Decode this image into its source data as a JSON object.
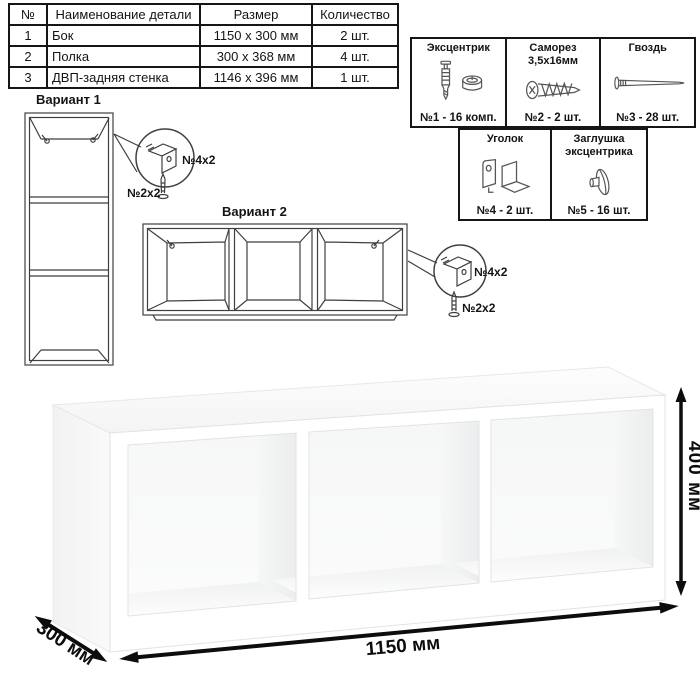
{
  "parts_table": {
    "headers": [
      "№",
      "Наименование детали",
      "Размер",
      "Количество"
    ],
    "rows": [
      {
        "num": "1",
        "name": "Бок",
        "size": "1150 х 300 мм",
        "qty": "2 шт."
      },
      {
        "num": "2",
        "name": "Полка",
        "size": "300 х 368 мм",
        "qty": "4 шт."
      },
      {
        "num": "3",
        "name": "ДВП-задняя стенка",
        "size": "1146 х 396 мм",
        "qty": "1 шт."
      }
    ]
  },
  "hardware": {
    "items": [
      {
        "title": "Эксцентрик",
        "title2": "",
        "icon": "cam-bolt-and-cam-icon",
        "count": "№1 - 16 комп."
      },
      {
        "title": "Саморез",
        "title2": "3,5х16мм",
        "icon": "screw-icon",
        "count": "№2 - 2 шт."
      },
      {
        "title": "Гвоздь",
        "title2": "",
        "icon": "nail-icon",
        "count": "№3 - 28 шт."
      },
      {
        "title": "Уголок",
        "title2": "",
        "icon": "corner-bracket-icon",
        "count": "№4 - 2 шт."
      },
      {
        "title": "Заглушка",
        "title2": "эксцентрика",
        "icon": "cam-cap-icon",
        "count": "№5 - 16 шт."
      }
    ]
  },
  "variant1": {
    "title": "Вариант 1",
    "bracket_label": "№4х2",
    "screw_label": "№2х2"
  },
  "variant2": {
    "title": "Вариант 2",
    "bracket_label": "№4х2",
    "screw_label": "№2х2"
  },
  "dimensions": {
    "height": "400 мм",
    "width": "1150 мм",
    "depth": "300 мм"
  },
  "colors": {
    "line_art": "#3f3f3f",
    "table_border": "#161616",
    "arrow": "#0d0d0d",
    "background": "#ffffff"
  }
}
